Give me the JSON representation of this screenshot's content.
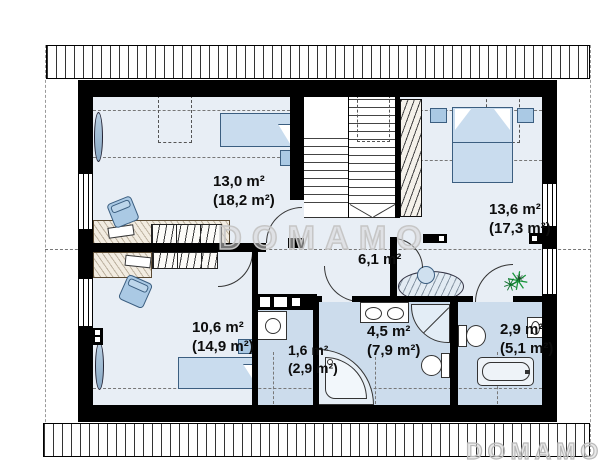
{
  "watermark": {
    "center": "DOMAMO",
    "corner": "DOMAMO"
  },
  "rooms": {
    "bedroom_left": {
      "area": "13,0 m²",
      "floor": "(18,2 m²)"
    },
    "bedroom_right": {
      "area": "13,6 m²",
      "floor": "(17,3 m²)"
    },
    "hall": {
      "area": "6,1 m²"
    },
    "bedroom_bottom": {
      "area": "10,6 m²",
      "floor": "(14,9 m²)"
    },
    "laundry": {
      "area": "1,6 m²",
      "floor": "(2,9 m²)"
    },
    "bathroom_main": {
      "area": "4,5 m²",
      "floor": "(7,9 m²)"
    },
    "bathroom_small": {
      "area": "2,9 m²",
      "floor": "(5,1 m²)"
    }
  },
  "colors": {
    "wall": "#000000",
    "floor": "#e8eef5",
    "wet_floor": "#ccdcec",
    "furniture": "#bad2e8",
    "watermark_outline": "#c6c6c6",
    "plant": "#17963a"
  }
}
